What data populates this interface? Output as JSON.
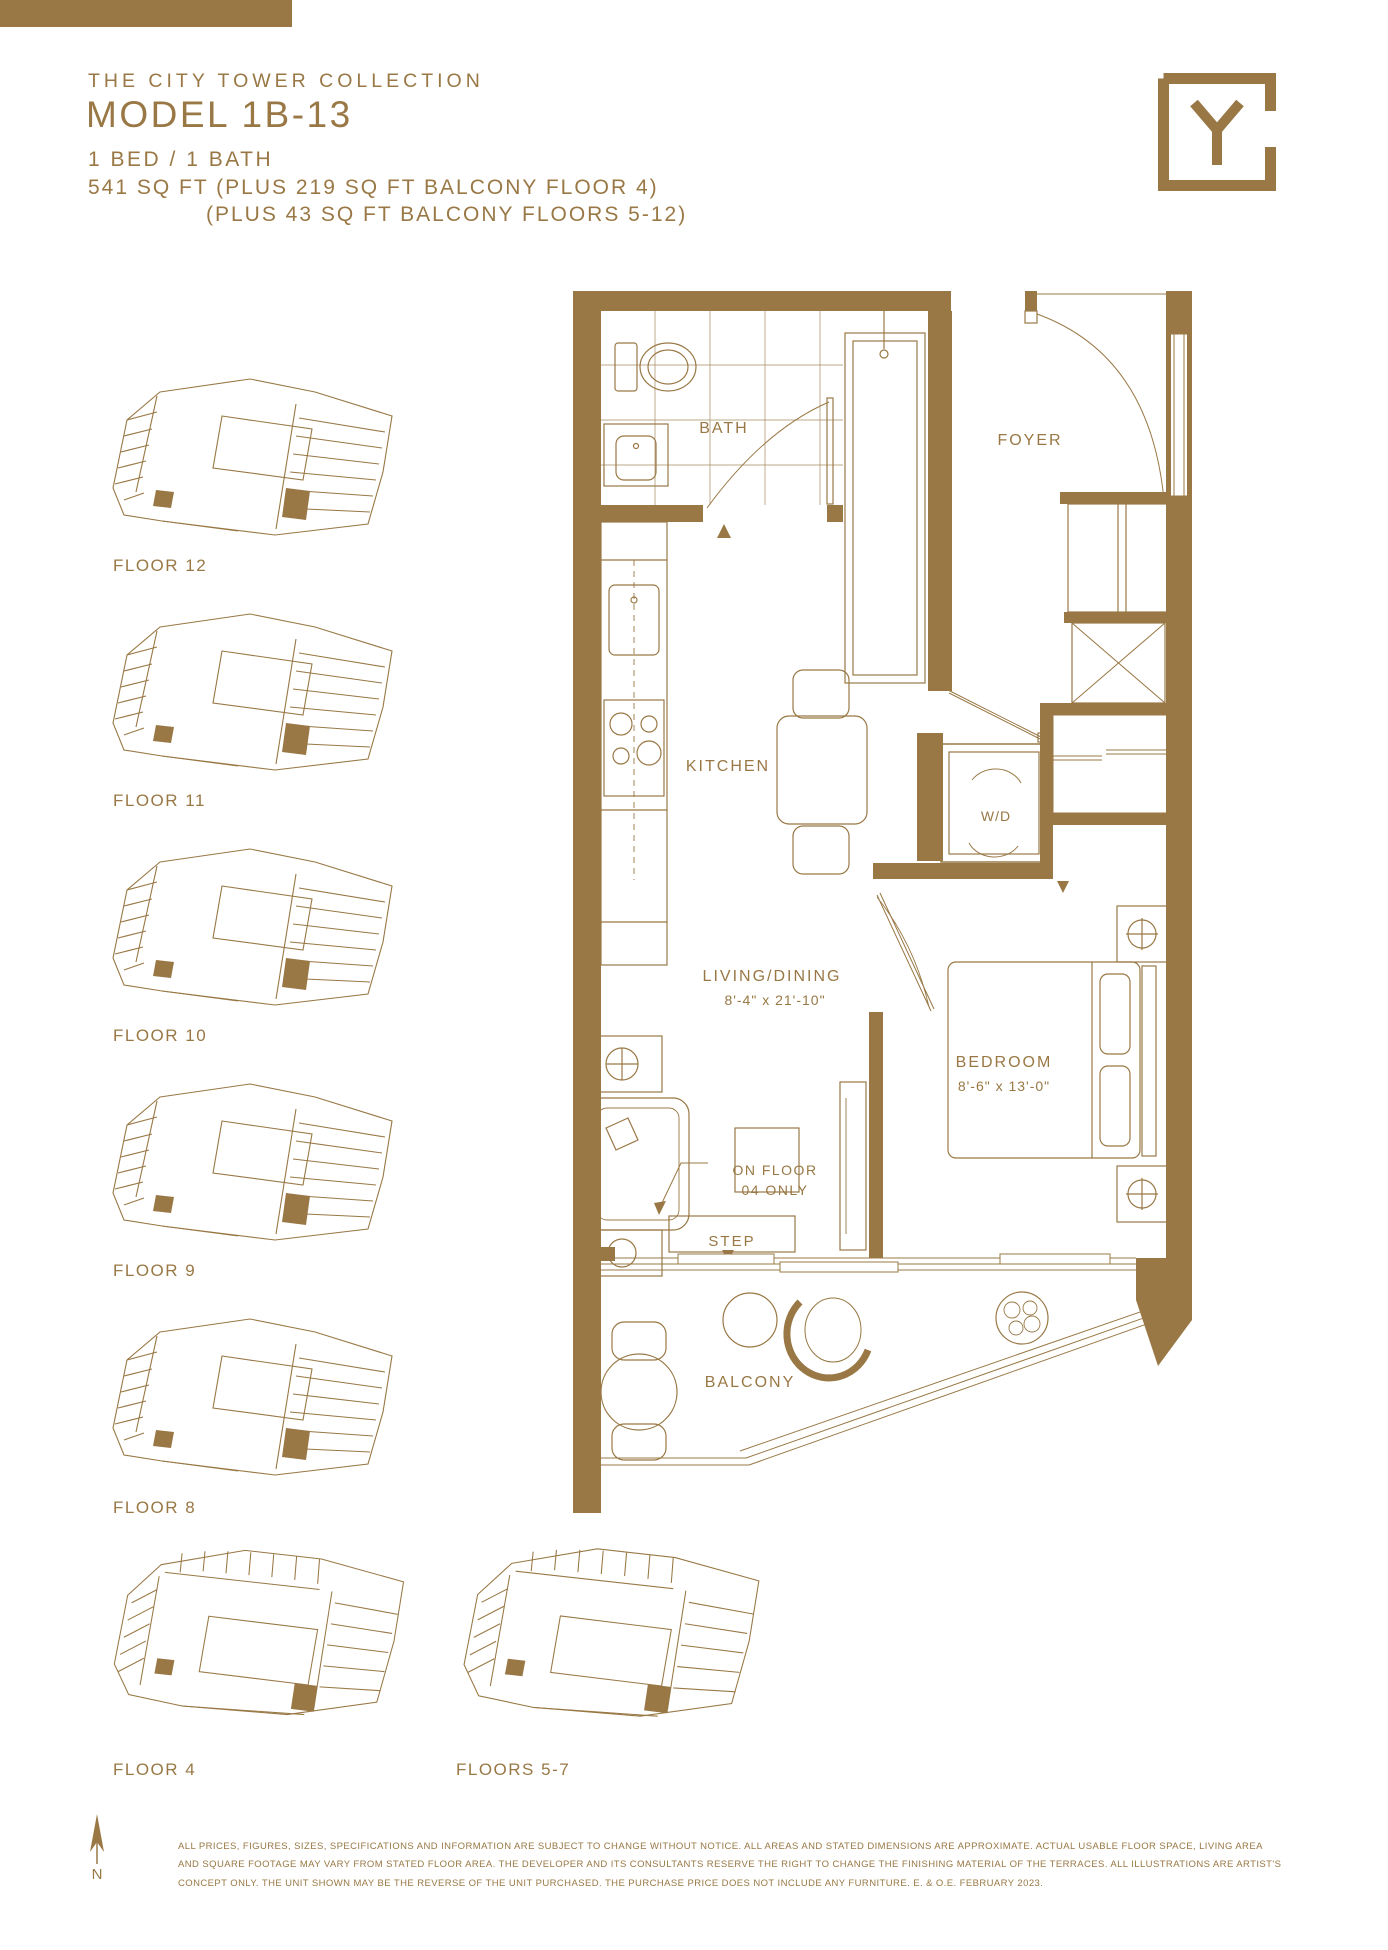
{
  "meta": {
    "accent_color": "#997845",
    "background_color": "#ffffff"
  },
  "header": {
    "collection": "THE CITY TOWER COLLECTION",
    "model": "MODEL 1B-13",
    "bed_bath": "1 BED / 1 BATH",
    "area_line1": "541 SQ FT (PLUS 219 SQ FT BALCONY FLOOR 4)",
    "area_line2": "(PLUS 43 SQ FT BALCONY FLOORS 5-12)"
  },
  "logo": {
    "letter": "Y"
  },
  "floorplan": {
    "bath": "BATH",
    "foyer": "FOYER",
    "kitchen": "KITCHEN",
    "washer_dryer": "W/D",
    "living_label": "LIVING/DINING",
    "living_dims": "8'-4\" x 21'-10\"",
    "bedroom_label": "BEDROOM",
    "bedroom_dims": "8'-6\" x 13'-0\"",
    "note_line1": "ON FLOOR",
    "note_line2": "04 ONLY",
    "step": "STEP",
    "balcony": "BALCONY"
  },
  "key_plans": [
    {
      "label": "FLOOR 12"
    },
    {
      "label": "FLOOR 11"
    },
    {
      "label": "FLOOR 10"
    },
    {
      "label": "FLOOR 9"
    },
    {
      "label": "FLOOR 8"
    },
    {
      "label": "FLOOR 4"
    },
    {
      "label": "FLOORS 5-7"
    }
  ],
  "footer": {
    "north_label": "N",
    "disclaimer_lines": [
      "ALL PRICES, FIGURES, SIZES, SPECIFICATIONS AND INFORMATION ARE SUBJECT TO CHANGE WITHOUT NOTICE. ALL AREAS AND STATED DIMENSIONS ARE APPROXIMATE. ACTUAL USABLE FLOOR SPACE, LIVING AREA",
      "AND SQUARE FOOTAGE MAY VARY FROM STATED FLOOR AREA. THE DEVELOPER AND ITS CONSULTANTS RESERVE THE RIGHT TO CHANGE THE FINISHING MATERIAL OF THE TERRACES. ALL ILLUSTRATIONS ARE ARTIST'S",
      "CONCEPT ONLY. THE UNIT SHOWN MAY BE THE REVERSE OF THE UNIT PURCHASED. THE PURCHASE PRICE DOES NOT INCLUDE ANY FURNITURE. E. & O.E. FEBRUARY 2023."
    ]
  }
}
